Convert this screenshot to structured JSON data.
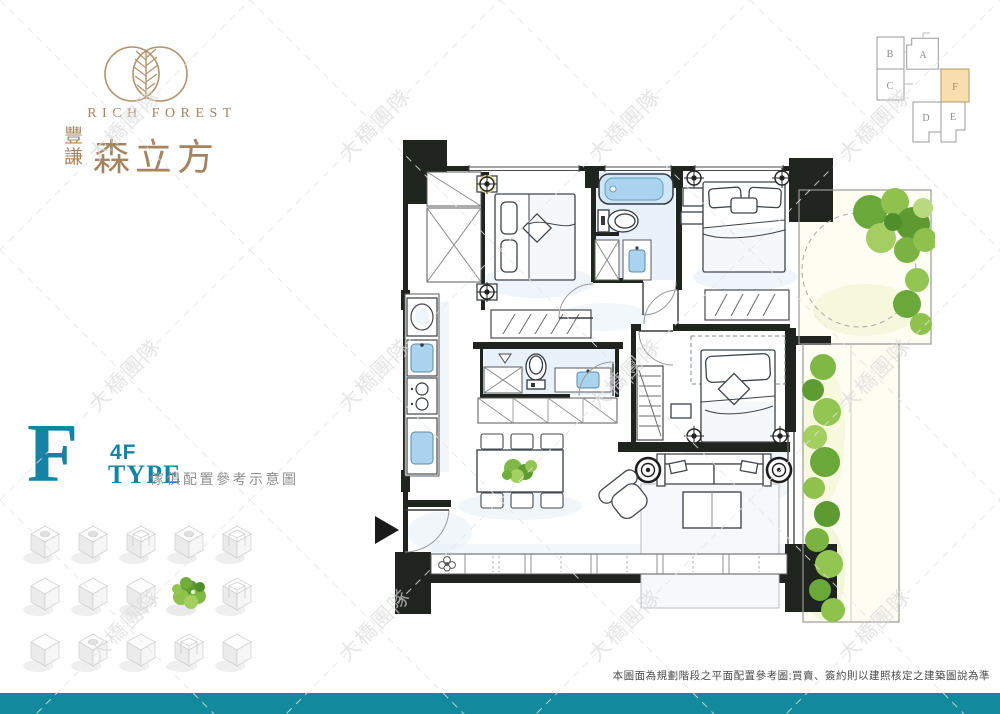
{
  "brand": {
    "name_en": "RICH FOREST",
    "name_zh_small": "豐謙",
    "name_zh_large": "森立方",
    "logo_color": "#a5845e"
  },
  "key_plan": {
    "units": [
      {
        "label": "A"
      },
      {
        "label": "B"
      },
      {
        "label": "C"
      },
      {
        "label": "D"
      },
      {
        "label": "E"
      },
      {
        "label": "F"
      }
    ],
    "highlighted_unit": "F",
    "highlight_color": "#f7e0ad"
  },
  "type_label": {
    "letter": "F",
    "floor": "4F",
    "type_word": "TYPE",
    "subtitle": "傢俱配置參考示意圖",
    "accent_color": "#1583a4"
  },
  "floor_plan": {
    "kind": "architectural-floor-plan",
    "fixtures": [
      "bed",
      "bed",
      "bed",
      "bathtub",
      "toilet",
      "toilet",
      "wash-basin",
      "washing-machine",
      "stove",
      "kitchen-sink",
      "dining-table",
      "dining-chairs",
      "potted-plant",
      "sofa",
      "coffee-table",
      "lounge-chair",
      "speakers",
      "wardrobes",
      "closets",
      "entrance-arrow",
      "balcony-trees"
    ],
    "wall_color": "#20241f",
    "fixture_blue": "#a9d3ee",
    "greens": [
      "#5d9c31",
      "#7fb844",
      "#a3cf5e"
    ]
  },
  "decor_cubes": {
    "rows": 3,
    "cols": 5,
    "green_cube": {
      "row": 2,
      "col": 4
    }
  },
  "watermark": {
    "text": "大橋團隊"
  },
  "footer": {
    "disclaimer": "本圖面為規劃階段之平面配置參考圖;買賣、簽約則以建照核定之建築圖說為準",
    "bar_color": "#12899c"
  }
}
